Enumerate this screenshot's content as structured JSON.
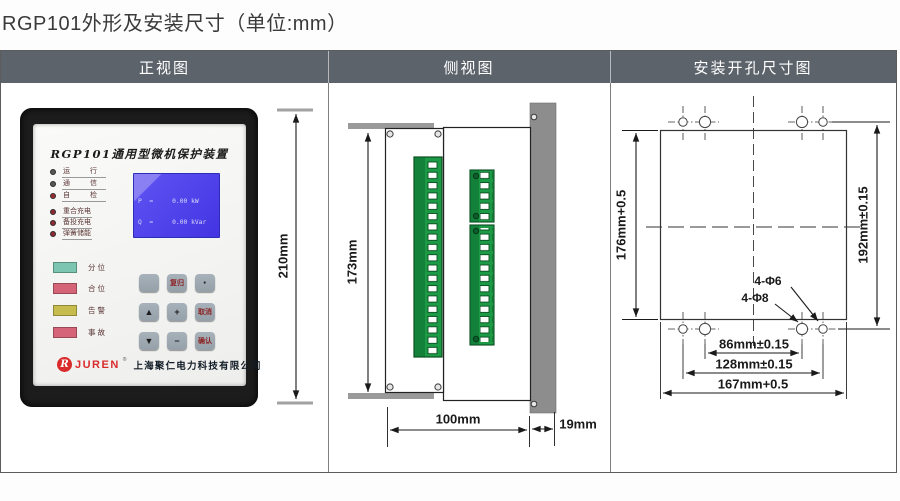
{
  "title": "RGP101外形及安装尺寸（单位:mm）",
  "tabs": {
    "front": "正视图",
    "side": "侧视图",
    "install": "安装开孔尺寸图"
  },
  "device": {
    "name": "RGP101通用型微机保护装置",
    "leds_basic": [
      {
        "label": "运 行",
        "color": "#575757"
      },
      {
        "label": "通 信",
        "color": "#575757"
      },
      {
        "label": "自 检",
        "color": "#9a2b33"
      }
    ],
    "leds_func": [
      {
        "label": "重合充电",
        "color": "#8f2a32"
      },
      {
        "label": "备投充电",
        "color": "#8f2a32"
      },
      {
        "label": "弹簧储能",
        "color": "#8f2a32"
      }
    ],
    "lcd": {
      "lines": [
        "P  =     0.00 kW",
        "Q  =     0.00 kVar",
        "PhI=     0.00 kWh",
        "QhI=     0.00 kVarh",
        "PhE=     0.00 kWh",
        "QhE=     0.00 kVarh"
      ],
      "datetime": "2013-06-25 15:09:55"
    },
    "status": [
      {
        "label": "分位",
        "color": "#7cc5b1"
      },
      {
        "label": "合位",
        "color": "#d56478"
      },
      {
        "label": "告警",
        "color": "#c6bd4e"
      },
      {
        "label": "事故",
        "color": "#d56478"
      }
    ],
    "keys": [
      "",
      "复归",
      "·",
      "▲",
      "+",
      "取消",
      "▼",
      "−",
      "确认"
    ],
    "brand": {
      "logo_initial": "R",
      "logo": "JUREN",
      "reg": "®",
      "company": "上海聚仁电力科技有限公司"
    }
  },
  "dims": {
    "front_height": "210mm",
    "side_height": "173mm",
    "side_width": "100mm",
    "side_depth": "19mm",
    "cutout_height": "176mm+0.5",
    "hole_span_v": "192mm±0.15",
    "hole_small": "4-Φ6",
    "hole_large": "4-Φ8",
    "hole_span_h1": "86mm±0.15",
    "hole_span_h2": "128mm±0.15",
    "cutout_width": "167mm+0.5"
  }
}
